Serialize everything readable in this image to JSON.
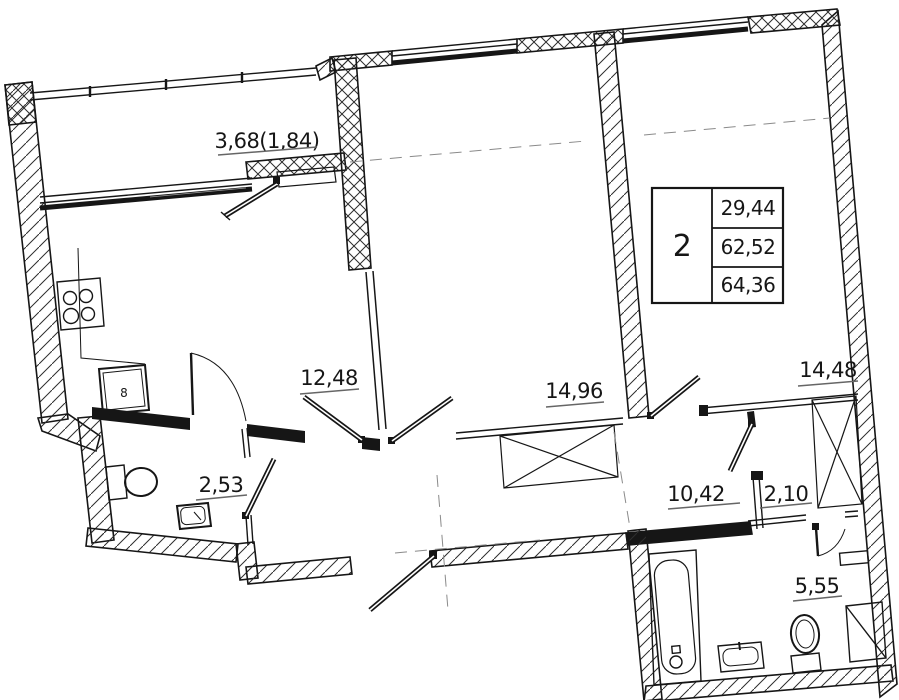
{
  "floor_plan": {
    "info_table": {
      "rooms_count": "2",
      "living_area": "29,44",
      "apartment_area": "62,52",
      "total_area": "64,36"
    },
    "rooms": {
      "balcony": {
        "area": "3,68(1,84)"
      },
      "kitchen": {
        "area": "12,48"
      },
      "bedroom": {
        "area": "14,96"
      },
      "living_room": {
        "area": "14,48"
      },
      "wc": {
        "area": "2,53"
      },
      "hallway": {
        "area": "10,42"
      },
      "storage": {
        "area": "2,10"
      },
      "bathroom": {
        "area": "5,55"
      }
    },
    "fixtures": {
      "kitchen_unit_label": "8"
    },
    "colors": {
      "ink": "#161616",
      "hatch": "#2e2e2e",
      "centerline": "#8a8a8a",
      "underline": "#666666"
    }
  }
}
